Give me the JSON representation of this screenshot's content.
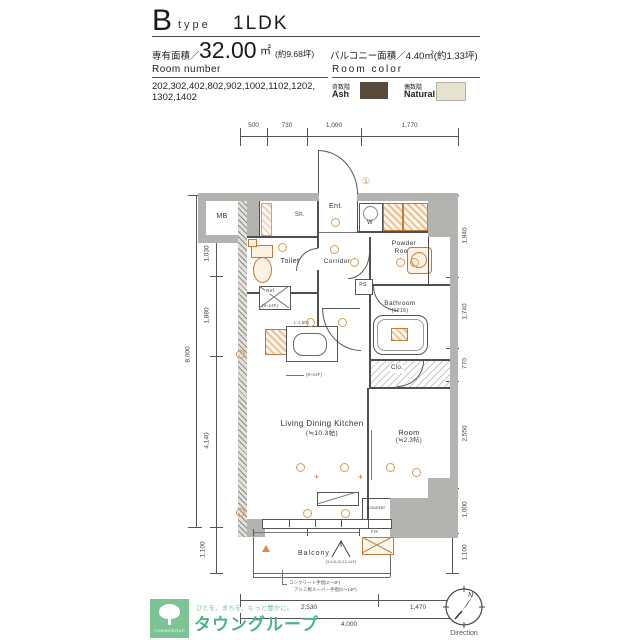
{
  "header": {
    "type_letter": "B",
    "type_word": "type",
    "layout": "1LDK",
    "area_label": "専有面積／",
    "area_value": "32.00",
    "area_unit": "㎡",
    "area_tsubo": "(約9.68坪)",
    "balcony_area": "バルコニー面積／4.40㎡(約1.33坪)",
    "room_number_label": "Room number",
    "room_numbers_line1": "202,302,402,802,902,1002,1102,1202,",
    "room_numbers_line2": "1302,1402",
    "room_color_label": "Room color",
    "swatch_ash_floor": "奇数階",
    "swatch_ash_name": "Ash",
    "swatch_ash_color": "#584a3d",
    "swatch_natural_floor": "偶数階",
    "swatch_natural_name": "Natural",
    "swatch_natural_color": "#e7e1d0"
  },
  "plan": {
    "rooms": {
      "mb": "MB",
      "ent": "Ent.",
      "sh": "Sh.",
      "w": "W",
      "toilet": "Toilet",
      "corridor": "Corridor",
      "powder_line1": "Powder",
      "powder_line2": "Room",
      "bathroom": "Bathroom",
      "bathroom_size": "(1216)",
      "ps": "PS",
      "clo": "Clo.",
      "ldk": "Living Dining Kitchen",
      "ldk_size": "(≒10.3帖)",
      "room": "Room",
      "room_size": "(≒2.3帖)",
      "counter": "Counter",
      "balcony": "Balcony",
      "fix_window": "FIX",
      "ref": "Ref."
    },
    "annotations": {
      "kitchen_length": "L-1,500",
      "floors_note": "(9~14F)",
      "hatch_floors": "(3,5,8,10,12,14F)",
      "rail_note1": "コンクリート手摺(2〜4F)",
      "rail_note2": "アルミ製ルーバー手摺(5〜14F)",
      "entrance_mark": "①"
    },
    "dims": {
      "top": [
        "500",
        "730",
        "1,000",
        "1,770"
      ],
      "left_total": "8,000",
      "left": [
        "850",
        "1,030",
        "1,880",
        "4,140"
      ],
      "left_bottom": "1,100",
      "right": [
        "1,940",
        "1,740",
        "770",
        "2,550",
        "1,000",
        "1,100"
      ],
      "bottom": [
        "2,530",
        "1,470"
      ],
      "bottom_total": "4,000"
    }
  },
  "footer": {
    "logo": {
      "tagline": "ひとを、まちを、もっと豊かに。",
      "name": "タウングループ",
      "mark": "TOWNGROUP",
      "green": "#4fb285"
    },
    "compass": {
      "north": "N",
      "label": "Direction"
    }
  },
  "colors": {
    "wall": "#b4b3af",
    "accent_orange": "#d78c3f"
  }
}
